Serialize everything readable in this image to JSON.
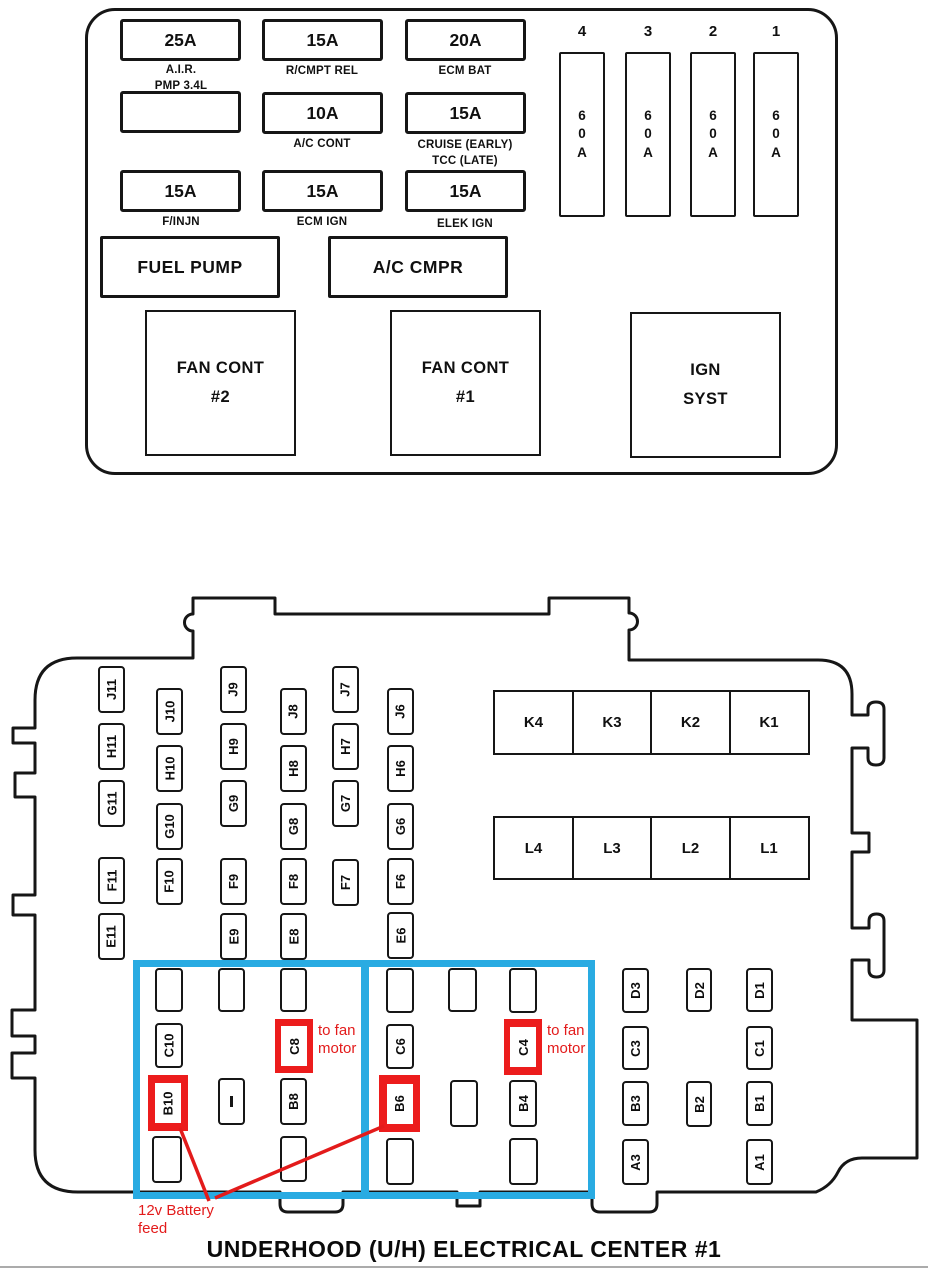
{
  "title": "UNDERHOOD (U/H) ELECTRICAL CENTER #1",
  "colors": {
    "highlight_red": "#EC1C1C",
    "callout_blue": "#29ABE2",
    "line_black": "#161616"
  },
  "top_panel": {
    "fuses": [
      {
        "amp": "25A",
        "name": "A.I.R.\nPMP 3.4L"
      },
      {
        "amp": "15A",
        "name": "R/CMPT REL"
      },
      {
        "amp": "20A",
        "name": "ECM BAT"
      },
      {
        "amp": "",
        "name": ""
      },
      {
        "amp": "10A",
        "name": "A/C CONT"
      },
      {
        "amp": "15A",
        "name": "CRUISE (EARLY)\nTCC (LATE)"
      },
      {
        "amp": "15A",
        "name": "F/INJN"
      },
      {
        "amp": "15A",
        "name": "ECM IGN"
      },
      {
        "amp": "15A",
        "name": "ELEK IGN"
      }
    ],
    "maxi_fuses": [
      {
        "position": "4",
        "amp": "60A"
      },
      {
        "position": "3",
        "amp": "60A"
      },
      {
        "position": "2",
        "amp": "60A"
      },
      {
        "position": "1",
        "amp": "60A"
      }
    ],
    "relays": [
      "FUEL PUMP",
      "A/C CMPR"
    ],
    "modules": [
      "FAN CONT\n#2",
      "FAN CONT\n#1",
      "IGN\nSYST"
    ]
  },
  "connector": {
    "grid": [
      "J11",
      "H11",
      "G11",
      "F11",
      "E11",
      "J10",
      "H10",
      "G10",
      "F10",
      "J9",
      "H9",
      "G9",
      "F9",
      "E9",
      "J8",
      "H8",
      "G8",
      "F8",
      "E8",
      "J7",
      "H7",
      "G7",
      "F7",
      "J6",
      "H6",
      "G6",
      "F6",
      "E6"
    ],
    "k_row": [
      "K4",
      "K3",
      "K2",
      "K1"
    ],
    "l_row": [
      "L4",
      "L3",
      "L2",
      "L1"
    ],
    "c_b_block": [
      "C10",
      "C8",
      "B10",
      "B8",
      "C6",
      "B6",
      "C4",
      "B4"
    ],
    "right_block": [
      "D3",
      "C3",
      "B3",
      "A3",
      "D2",
      "B2",
      "D1",
      "C1",
      "B1",
      "A1"
    ]
  },
  "annotations": {
    "fan_motor_1": "to fan\nmotor",
    "fan_motor_2": "to fan\nmotor",
    "battery_feed": "12v Battery\nfeed"
  }
}
